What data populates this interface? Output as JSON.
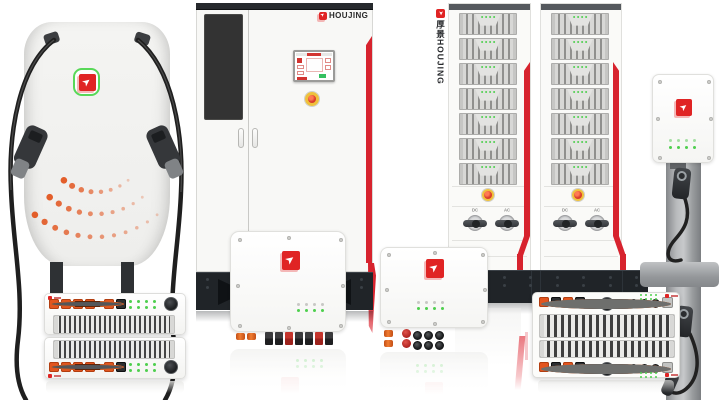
{
  "background": "#ffffff",
  "brand": {
    "name": "HOUJING",
    "name_cn": "厚景"
  },
  "cabinet": {
    "brand_label": "HOUJING"
  },
  "racks": {
    "vertical_brand_label": "厚景HOUJING",
    "module_count": 7,
    "module_led_count": 4,
    "switch_labels": [
      "DC",
      "AC"
    ]
  },
  "colors": {
    "accent_red": "#d7232e",
    "logo_red": "#e02424",
    "logo_green": "#58d858",
    "led_green": "#4ecf4e",
    "connector_orange": "#e2551f",
    "estop_yellow": "#eec13c",
    "estop_red": "#d93a2b",
    "dark_base": "#202428",
    "cable_black": "#212121"
  }
}
